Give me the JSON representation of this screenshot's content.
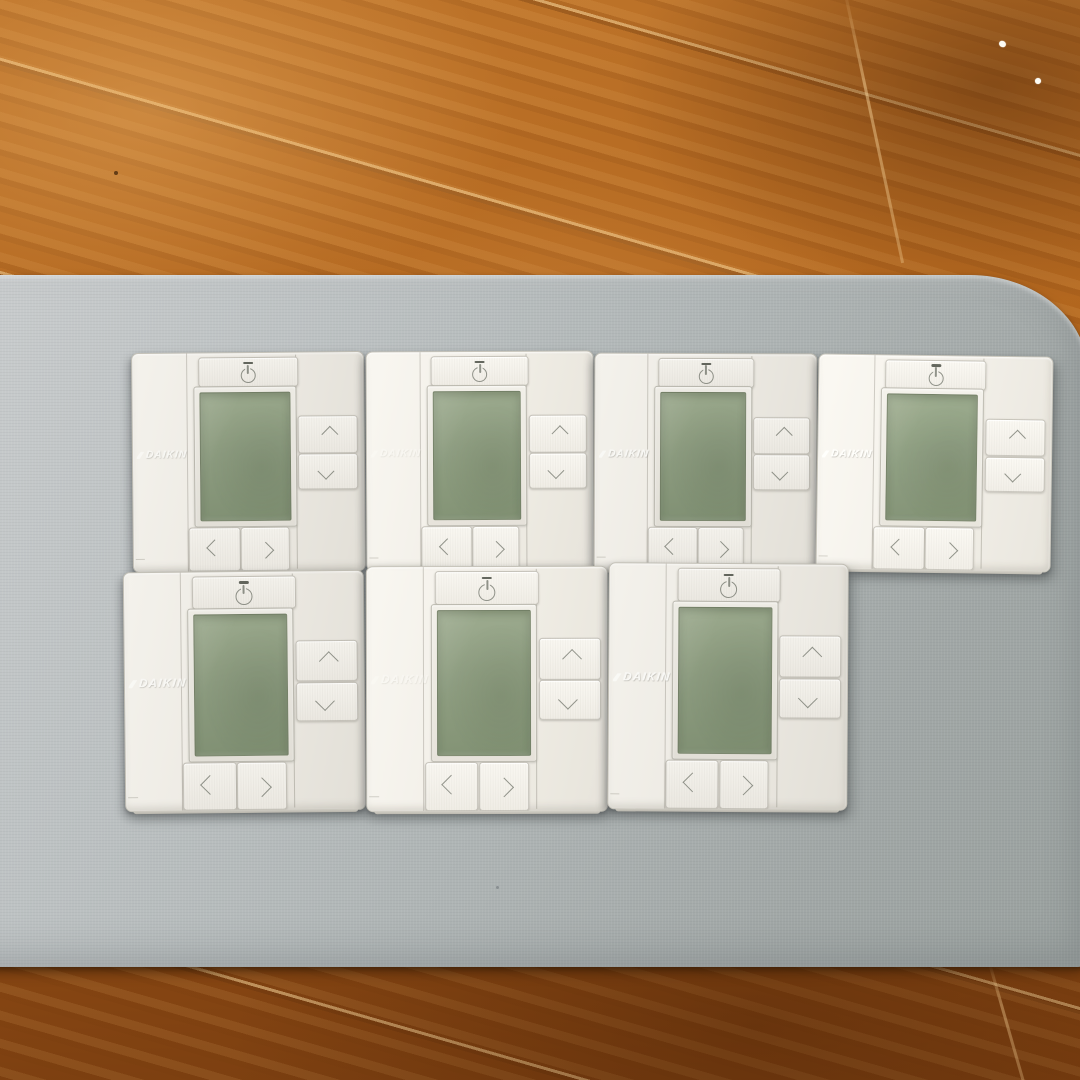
{
  "scene": {
    "objects": [
      "wood-floor",
      "gray-fabric-mat",
      "daikin-remote-controllers"
    ],
    "controller_count": 7,
    "rows": [
      {
        "position": "top",
        "count": 4
      },
      {
        "position": "bottom",
        "count": 3
      }
    ]
  },
  "colors": {
    "wood_floor": "#b2661e",
    "wood_floor_dark": "#7a3e10",
    "mat_gray": "#b4b9ba",
    "controller_body": "#ece9e2",
    "lcd_green": "#8a997d",
    "icon_gray": "#8e9087",
    "brand_white": "#fafaf7"
  },
  "controllers": [
    {
      "id": "top-1",
      "brand": "DAIKIN",
      "display": "blank",
      "buttons": [
        "power",
        "up",
        "down",
        "left",
        "right"
      ]
    },
    {
      "id": "top-2",
      "brand": "DAIKIN",
      "display": "blank",
      "buttons": [
        "power",
        "up",
        "down",
        "left",
        "right"
      ]
    },
    {
      "id": "top-3",
      "brand": "DAIKIN",
      "display": "blank",
      "buttons": [
        "power",
        "up",
        "down",
        "left",
        "right"
      ]
    },
    {
      "id": "top-4",
      "brand": "DAIKIN",
      "display": "blank",
      "buttons": [
        "power",
        "up",
        "down",
        "left",
        "right"
      ]
    },
    {
      "id": "bottom-1",
      "brand": "DAIKIN",
      "display": "blank",
      "buttons": [
        "power",
        "up",
        "down",
        "left",
        "right"
      ]
    },
    {
      "id": "bottom-2",
      "brand": "DAIKIN",
      "display": "blank",
      "buttons": [
        "power",
        "up",
        "down",
        "left",
        "right"
      ]
    },
    {
      "id": "bottom-3",
      "brand": "DAIKIN",
      "display": "blank",
      "buttons": [
        "power",
        "up",
        "down",
        "left",
        "right"
      ]
    }
  ]
}
